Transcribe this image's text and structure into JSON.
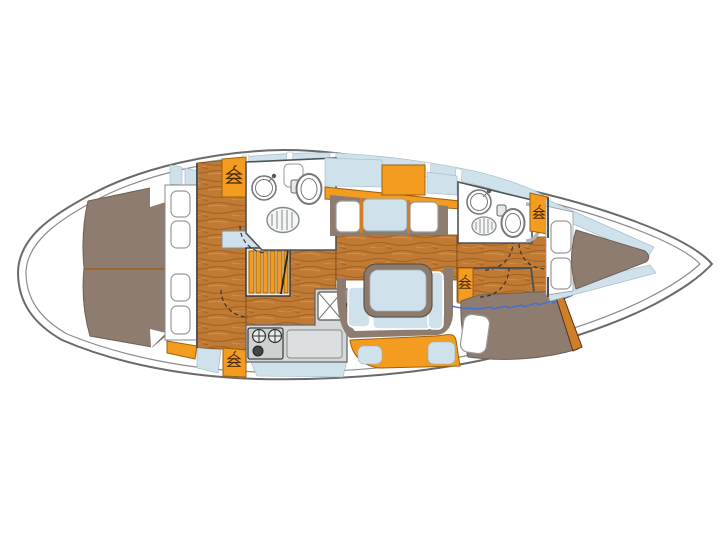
{
  "diagram": {
    "title": "Sailboat interior layout floorplan",
    "type": "floorplan",
    "orientation": {
      "bow": "right",
      "stern": "left"
    },
    "colors": {
      "hull-line": "#6a6a6a",
      "hull-inner-line": "#8c8c8c",
      "deck": "#ffffff",
      "panel-blue": "#cfe2ec",
      "panel-blue-edge": "#9db4c2",
      "wood-base": "#c07a33",
      "wood-grain": "#9e5d20",
      "wood-grain-light": "#d79a55",
      "bed": "#8d7c6f",
      "bed-edge": "#6e6155",
      "bed-seam": "#a35c13",
      "accent-orange": "#f39c1f",
      "accent-orange-edge": "#9a6210",
      "counter-gray": "#d5d8d9",
      "counter-edge": "#666666",
      "quilt-blue": "#3c6fd6",
      "fixture-line": "#777777",
      "wall-line": "#4d5358",
      "door-dash": "#333333",
      "hanger-icon": "#4a2a08",
      "wood-trim": "#cf7f2a",
      "stair-frame": "#efe9dd"
    },
    "rooms": [
      "aft-owner-cabin",
      "aft-head",
      "companionway",
      "galley",
      "salon-settee",
      "dinette",
      "forward-head",
      "quarter-berth-cabin",
      "bow-v-berth-cabin"
    ],
    "fixtures": [
      "double-berth",
      "pillows",
      "hanging-locker",
      "companionway-stairs",
      "wash-basin",
      "toilet",
      "shower-grate",
      "stove-burners",
      "galley-sink",
      "chopping-board",
      "dinette-table",
      "settee-cushions",
      "v-berth",
      "quarter-berth"
    ]
  }
}
